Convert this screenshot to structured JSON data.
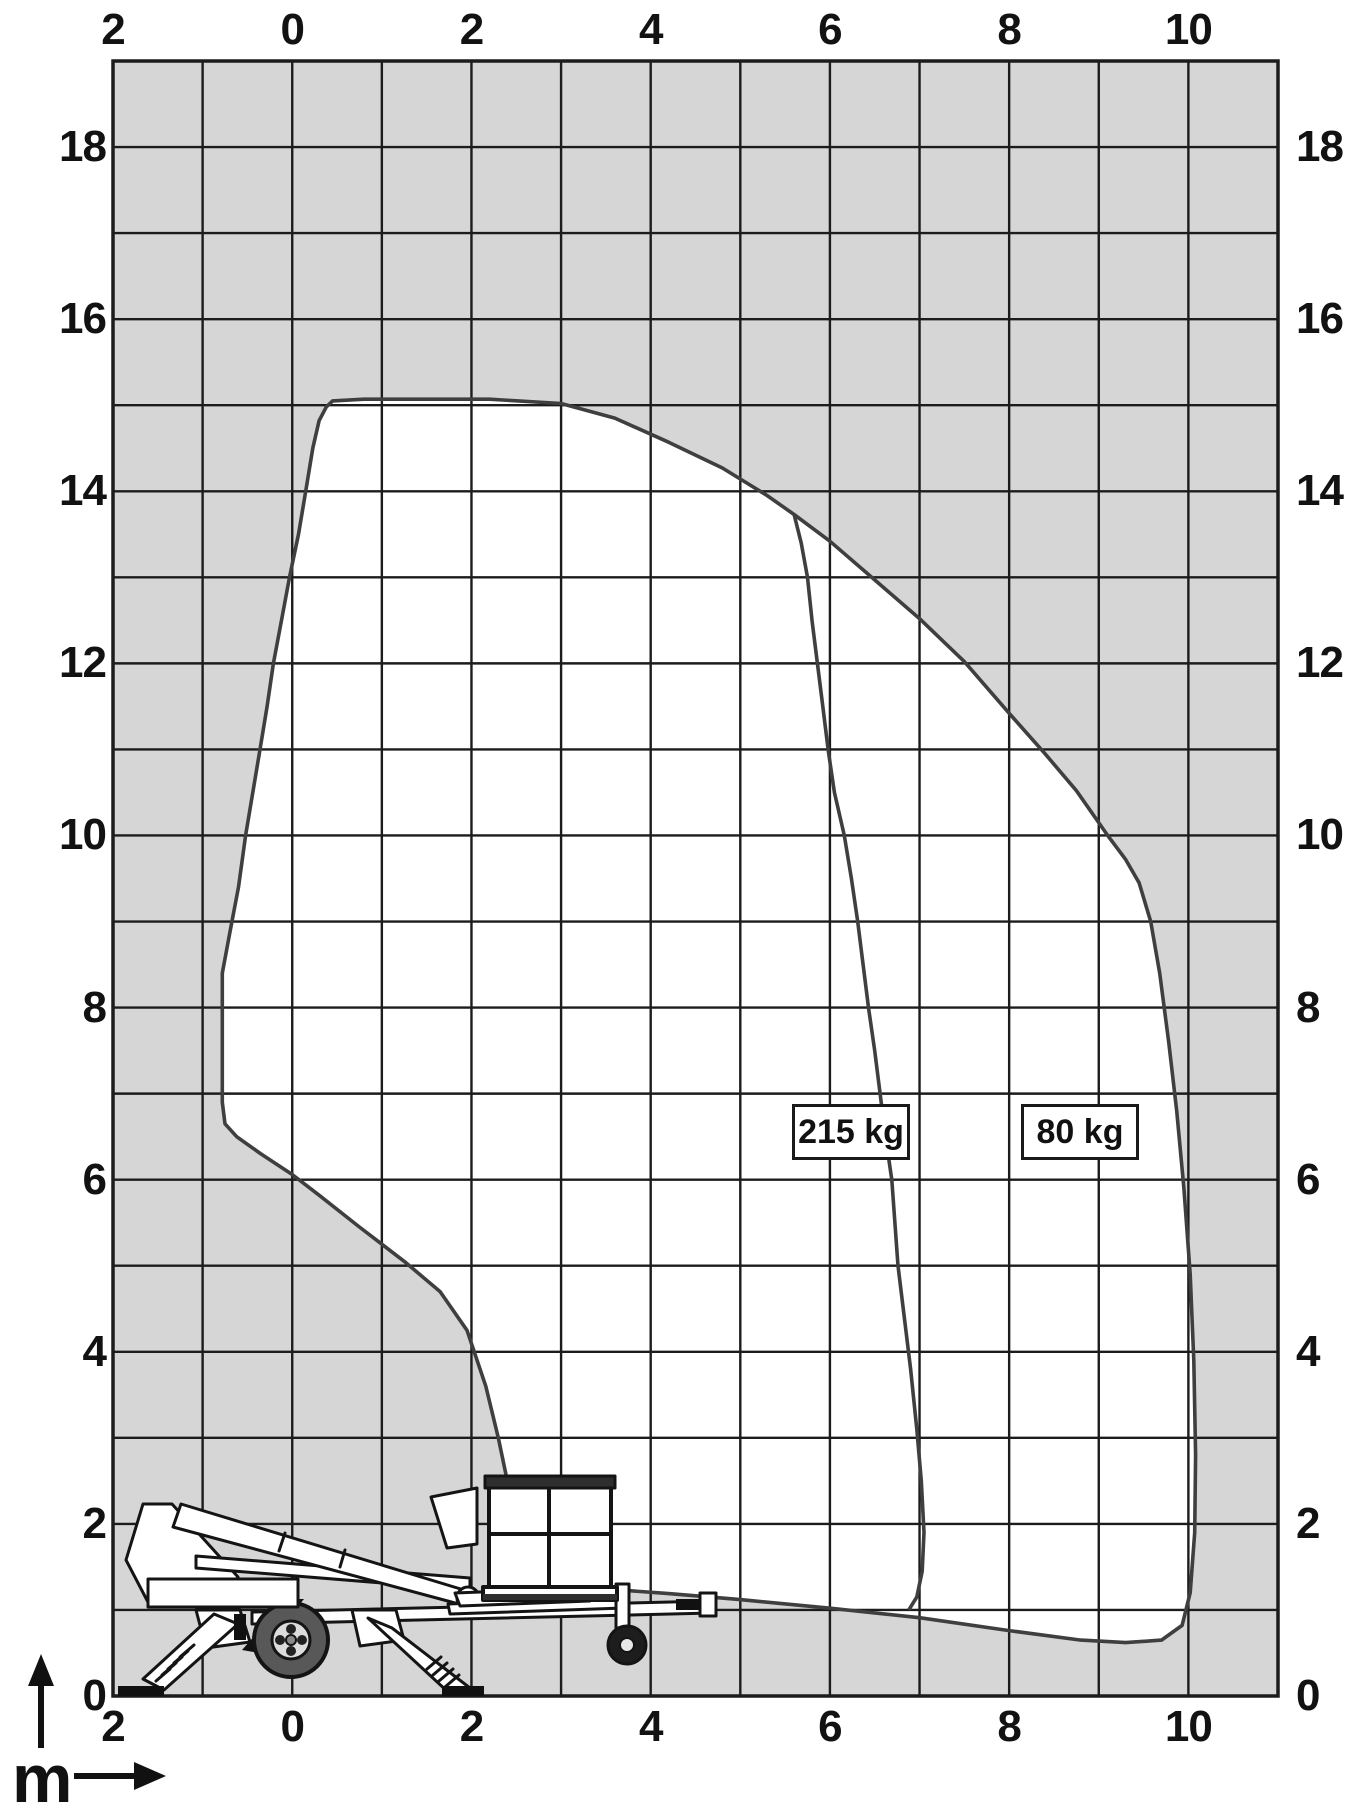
{
  "chart_data": {
    "type": "area",
    "title": "",
    "subtitle": "",
    "unit_label": "m",
    "x_axis": {
      "range": [
        -2,
        11
      ],
      "gridline_step": 1,
      "tick_values": [
        -2,
        0,
        2,
        4,
        6,
        8,
        10
      ],
      "tick_labels": [
        "2",
        "0",
        "2",
        "4",
        "6",
        "8",
        "10"
      ],
      "unit": "m"
    },
    "y_axis": {
      "range": [
        0,
        19
      ],
      "gridline_step": 1,
      "left_tick_values": [
        18,
        16,
        14,
        12,
        10,
        8,
        6,
        4,
        2,
        0
      ],
      "left_tick_labels": [
        "18",
        "16",
        "14",
        "12",
        "10",
        "8",
        "6",
        "4",
        "2",
        "0"
      ],
      "right_tick_values": [
        18,
        16,
        14,
        12,
        10,
        8,
        6,
        4,
        2,
        0
      ],
      "right_tick_labels": [
        "18",
        "16",
        "14",
        "12",
        "10",
        "8",
        "6",
        "4",
        "2",
        "0"
      ],
      "unit": "m"
    },
    "series": [
      {
        "name": "80 kg working envelope",
        "label": "80 kg",
        "closed": true,
        "points": [
          [
            0.45,
            15.05
          ],
          [
            0.8,
            15.07
          ],
          [
            1.5,
            15.07
          ],
          [
            2.2,
            15.07
          ],
          [
            3.0,
            15.02
          ],
          [
            3.6,
            14.85
          ],
          [
            4.2,
            14.57
          ],
          [
            4.8,
            14.27
          ],
          [
            5.3,
            13.95
          ],
          [
            5.6,
            13.73
          ],
          [
            6.0,
            13.42
          ],
          [
            6.5,
            12.97
          ],
          [
            7.0,
            12.52
          ],
          [
            7.5,
            12.02
          ],
          [
            8.0,
            11.42
          ],
          [
            8.4,
            10.95
          ],
          [
            8.75,
            10.52
          ],
          [
            9.1,
            10.0
          ],
          [
            9.3,
            9.72
          ],
          [
            9.45,
            9.45
          ],
          [
            9.58,
            9.0
          ],
          [
            9.68,
            8.4
          ],
          [
            9.78,
            7.6
          ],
          [
            9.87,
            6.8
          ],
          [
            9.95,
            5.9
          ],
          [
            10.02,
            4.9
          ],
          [
            10.06,
            3.9
          ],
          [
            10.08,
            2.8
          ],
          [
            10.07,
            1.9
          ],
          [
            10.02,
            1.2
          ],
          [
            9.93,
            0.82
          ],
          [
            9.7,
            0.65
          ],
          [
            9.3,
            0.62
          ],
          [
            8.8,
            0.65
          ],
          [
            8.0,
            0.76
          ],
          [
            7.0,
            0.91
          ],
          [
            6.0,
            1.02
          ],
          [
            5.0,
            1.12
          ],
          [
            4.2,
            1.19
          ],
          [
            3.55,
            1.24
          ],
          [
            3.1,
            1.26
          ],
          [
            2.85,
            1.3
          ],
          [
            2.68,
            1.42
          ],
          [
            2.57,
            1.65
          ],
          [
            2.5,
            1.95
          ],
          [
            2.42,
            2.4
          ],
          [
            2.3,
            3.0
          ],
          [
            2.16,
            3.6
          ],
          [
            1.95,
            4.25
          ],
          [
            1.65,
            4.7
          ],
          [
            1.25,
            5.05
          ],
          [
            0.75,
            5.45
          ],
          [
            0.3,
            5.82
          ],
          [
            0.0,
            6.06
          ],
          [
            -0.35,
            6.3
          ],
          [
            -0.62,
            6.5
          ],
          [
            -0.75,
            6.65
          ],
          [
            -0.78,
            6.9
          ],
          [
            -0.78,
            7.6
          ],
          [
            -0.78,
            8.4
          ],
          [
            -0.7,
            8.85
          ],
          [
            -0.6,
            9.4
          ],
          [
            -0.52,
            10.0
          ],
          [
            -0.44,
            10.5
          ],
          [
            -0.36,
            11.0
          ],
          [
            -0.28,
            11.5
          ],
          [
            -0.21,
            12.0
          ],
          [
            -0.12,
            12.5
          ],
          [
            -0.03,
            13.0
          ],
          [
            0.07,
            13.5
          ],
          [
            0.15,
            14.0
          ],
          [
            0.23,
            14.5
          ],
          [
            0.3,
            14.82
          ],
          [
            0.38,
            14.98
          ]
        ]
      },
      {
        "name": "215 kg limit line",
        "label": "215 kg",
        "closed": false,
        "points": [
          [
            5.6,
            13.73
          ],
          [
            5.68,
            13.4
          ],
          [
            5.75,
            13.0
          ],
          [
            5.8,
            12.5
          ],
          [
            5.86,
            12.0
          ],
          [
            5.92,
            11.5
          ],
          [
            5.98,
            11.0
          ],
          [
            6.05,
            10.5
          ],
          [
            6.16,
            10.0
          ],
          [
            6.24,
            9.5
          ],
          [
            6.31,
            9.0
          ],
          [
            6.37,
            8.5
          ],
          [
            6.43,
            8.0
          ],
          [
            6.5,
            7.5
          ],
          [
            6.56,
            7.0
          ],
          [
            6.62,
            6.5
          ],
          [
            6.69,
            6.0
          ],
          [
            6.76,
            5.0
          ],
          [
            6.83,
            4.4
          ],
          [
            6.9,
            3.8
          ],
          [
            6.97,
            3.1
          ],
          [
            7.02,
            2.5
          ],
          [
            7.05,
            1.9
          ],
          [
            7.03,
            1.45
          ],
          [
            6.97,
            1.15
          ],
          [
            6.88,
            1.0
          ]
        ]
      }
    ],
    "annotations": [
      {
        "text": "215 kg",
        "x": 6.2,
        "y": 6.5
      },
      {
        "text": "80 kg",
        "x": 8.77,
        "y": 6.5
      }
    ],
    "legend": "none",
    "grid": "on",
    "colors": {
      "outside_fill": "#d6d6d6",
      "inside_fill": "#ffffff",
      "grid_line": "#1c1c1c",
      "curve": "#3f3f3f"
    }
  },
  "illustration": {
    "name": "trailer-mounted-boom-lift-side-view",
    "parts": [
      "basket",
      "telescopic-boom",
      "turret",
      "engine-body",
      "chassis",
      "outrigger-legs",
      "road-wheel",
      "jockey-wheel",
      "tow-hitch"
    ]
  }
}
